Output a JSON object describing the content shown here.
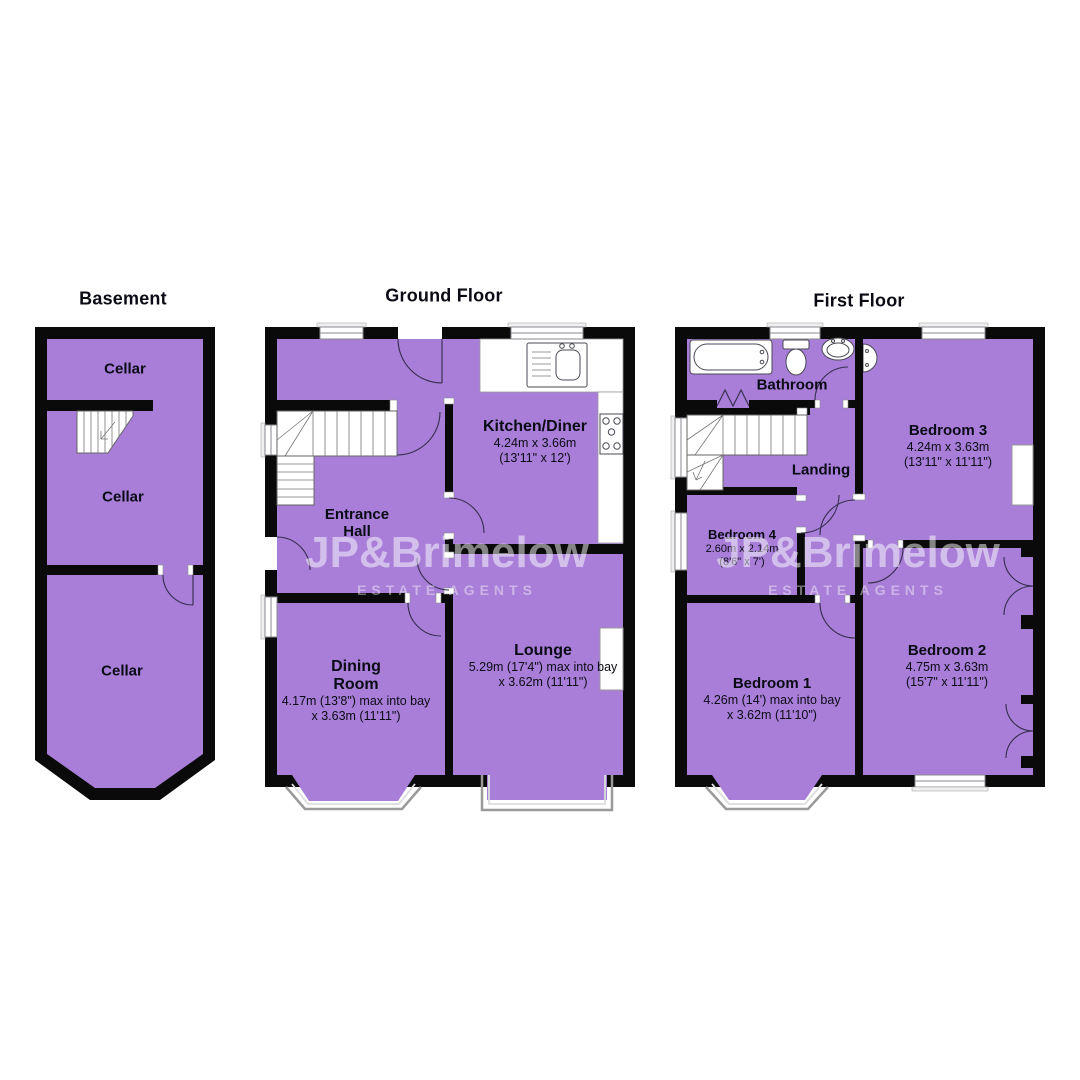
{
  "colors": {
    "room_fill": "#a87ed8",
    "wall": "#0a0a0a",
    "watermark_text": "#ffffff"
  },
  "watermark": {
    "name": "JP&Brimelow",
    "tagline": "ESTATE AGENTS"
  },
  "floors": {
    "basement": {
      "title": "Basement",
      "rooms": [
        {
          "name": "Cellar"
        },
        {
          "name": "Cellar"
        },
        {
          "name": "Cellar"
        }
      ]
    },
    "ground": {
      "title": "Ground Floor",
      "rooms": [
        {
          "name": "Kitchen/Diner",
          "dim_metric": "4.24m x 3.66m",
          "dim_imperial": "(13'11\" x 12')"
        },
        {
          "name": "Entrance Hall"
        },
        {
          "name": "Dining Room",
          "dim_metric": "4.17m (13'8\") max into bay",
          "dim_imperial": "x 3.63m (11'11\")"
        },
        {
          "name": "Lounge",
          "dim_metric": "5.29m (17'4\") max into bay",
          "dim_imperial": "x 3.62m (11'11\")"
        }
      ]
    },
    "first": {
      "title": "First Floor",
      "rooms": [
        {
          "name": "Bathroom"
        },
        {
          "name": "Bedroom 3",
          "dim_metric": "4.24m x 3.63m",
          "dim_imperial": "(13'11\" x 11'11\")"
        },
        {
          "name": "Landing"
        },
        {
          "name": "Bedroom 4",
          "dim_metric": "2.60m x 2.14m",
          "dim_imperial": "(8'6\" x 7')"
        },
        {
          "name": "Bedroom 1",
          "dim_metric": "4.26m (14') max into bay",
          "dim_imperial": "x 3.62m (11'10\")"
        },
        {
          "name": "Bedroom 2",
          "dim_metric": "4.75m x 3.63m",
          "dim_imperial": "(15'7\" x 11'11\")"
        }
      ]
    }
  }
}
